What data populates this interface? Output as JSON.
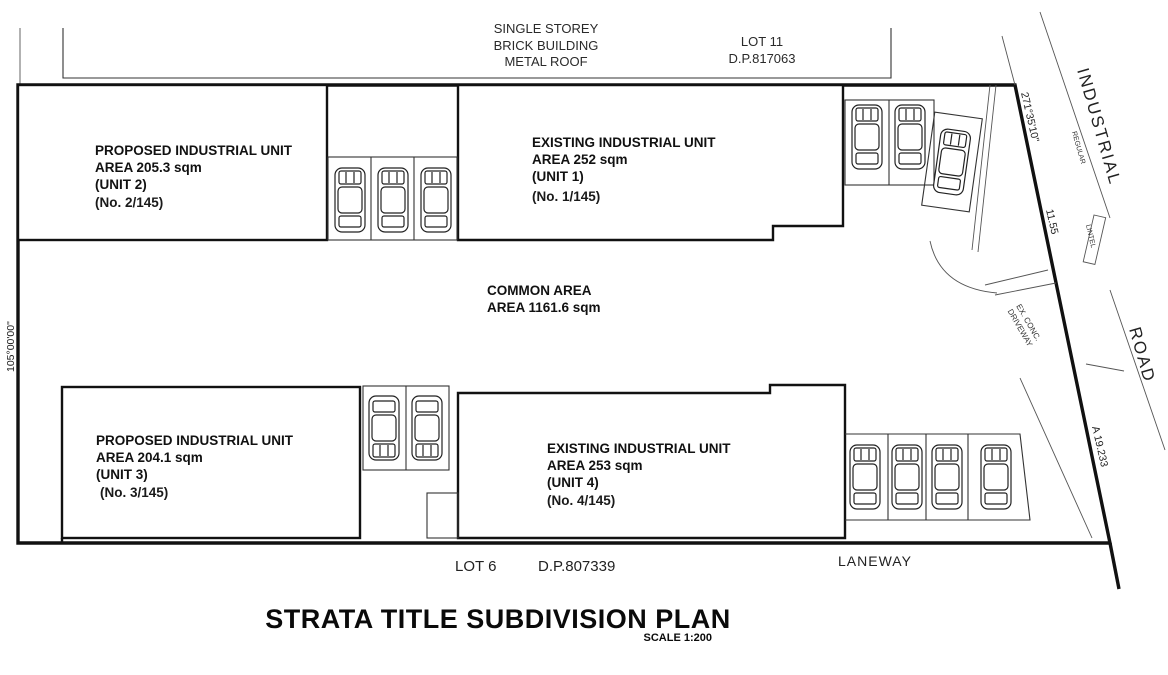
{
  "plan": {
    "title": "STRATA TITLE SUBDIVISION PLAN",
    "scale": "SCALE 1:200",
    "neighbor_building": {
      "line1": "SINGLE STOREY",
      "line2": "BRICK BUILDING",
      "line3": "METAL ROOF"
    },
    "lot11": {
      "line1": "LOT 11",
      "line2": "D.P.817063"
    },
    "units": [
      {
        "id": "unit-2",
        "type_label": "PROPOSED INDUSTRIAL UNIT",
        "area_label": "AREA 205.3 sqm",
        "unit_label": "(UNIT 2)",
        "strata_no": "(No. 2/145)"
      },
      {
        "id": "unit-1",
        "type_label": "EXISTING INDUSTRIAL UNIT",
        "area_label": "AREA 252 sqm",
        "unit_label": "(UNIT 1)",
        "strata_no": "(No. 1/145)"
      },
      {
        "id": "unit-3",
        "type_label": "PROPOSED INDUSTRIAL UNIT",
        "area_label": "AREA 204.1 sqm",
        "unit_label": "(UNIT 3)",
        "strata_no": "(No. 3/145)"
      },
      {
        "id": "unit-4",
        "type_label": "EXISTING INDUSTRIAL UNIT",
        "area_label": "AREA 253 sqm",
        "unit_label": "(UNIT 4)",
        "strata_no": "(No. 4/145)"
      }
    ],
    "common_area": {
      "line1": "COMMON AREA",
      "line2": "AREA 1161.6 sqm"
    },
    "boundary_labels": {
      "left_bearing": "105°00'00\"",
      "right_bearing": "271°35'10\"",
      "right_dim": "11.55",
      "arc_dim": "A 19.233"
    },
    "road": {
      "name_top": "INDUSTRIAL",
      "name_bottom": "ROAD",
      "regular_note": "REGULAR",
      "lintel_note": "LINTEL",
      "driveway_line1": "EX. CONC.",
      "driveway_line2": "DRIVEWAY"
    },
    "bottom_labels": {
      "lot6": "LOT 6",
      "dp": "D.P.807339",
      "laneway": "LANEWAY"
    },
    "colors": {
      "line": "#1a1a1a",
      "strata_no_blue": "#0f2ccb"
    }
  }
}
